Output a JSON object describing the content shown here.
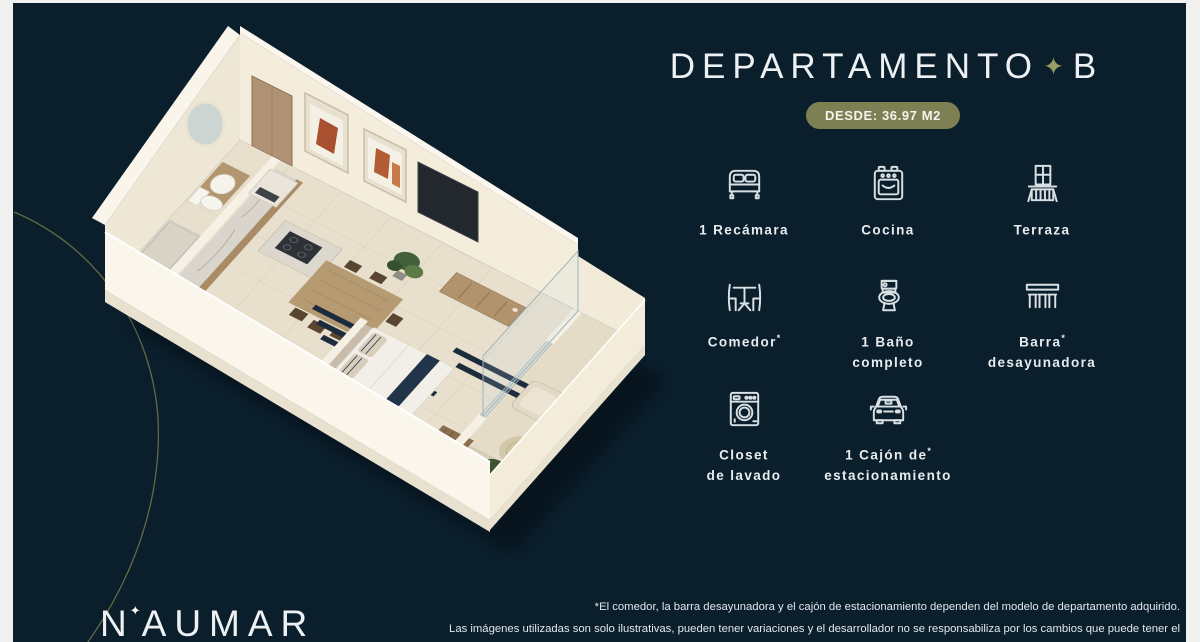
{
  "colors": {
    "slide_background": "#0a1e2c",
    "badge_olive": "#7d8053",
    "star_olive": "#9a9d63",
    "text_white": "#edf1f3",
    "curve_olive": "#6e7245"
  },
  "title": {
    "text": "DEPARTAMENTO",
    "star_icon": "✦",
    "unit": "B"
  },
  "badge": {
    "label": "DESDE: 36.97 M2"
  },
  "features": [
    {
      "icon": "bed-icon",
      "line1": "1 Recámara"
    },
    {
      "icon": "stove-icon",
      "line1": "Cocina"
    },
    {
      "icon": "balcony-icon",
      "line1": "Terraza"
    },
    {
      "icon": "dining-table-icon",
      "line1": "Comedor",
      "sup": "*"
    },
    {
      "icon": "toilet-icon",
      "line1": "1 Baño",
      "line2": "completo"
    },
    {
      "icon": "breakfast-bar-icon",
      "line1": "Barra",
      "sup": "*",
      "line2": "desayunadora"
    },
    {
      "icon": "washing-machine-icon",
      "line1": "Closet",
      "line2": "de lavado"
    },
    {
      "icon": "car-icon",
      "line1": "1 Cajón de",
      "sup": "*",
      "line2": "estacionamiento"
    }
  ],
  "disclaimer": {
    "line1": "*El comedor, la barra desayunadora y el cajón de estacionamiento dependen del modelo de departamento adquirido.",
    "line2": "Las imágenes utilizadas son solo ilustrativas, pueden tener variaciones y el desarrollador no se responsabiliza por los cambios que puede tener el proyecto."
  },
  "logo": {
    "prefix": "N",
    "star": "✦",
    "suffix": "AUMAR"
  }
}
